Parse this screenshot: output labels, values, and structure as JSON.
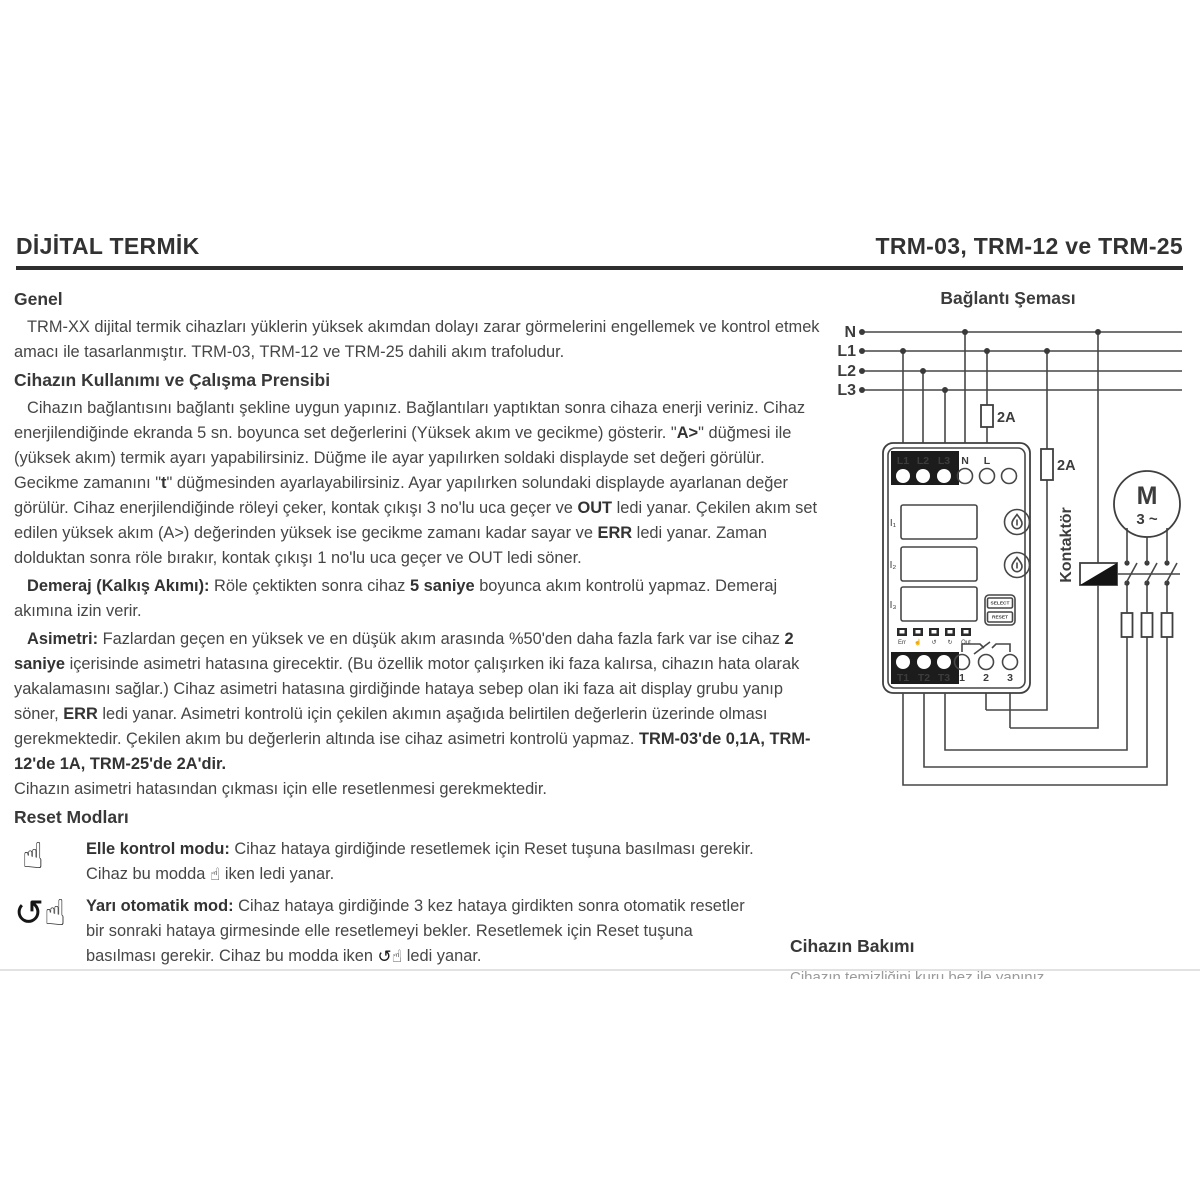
{
  "page": {
    "header": {
      "title_left": "DİJİTAL TERMİK",
      "title_right": "TRM-03, TRM-12 ve TRM-25"
    },
    "icons": {
      "manual_reset": "☝",
      "semi_auto_reset": "↺☝"
    },
    "sections": {
      "genel_heading": "Genel",
      "genel_paragraph": [
        {
          "t": "TRM-XX dijital termik cihazları yüklerin yüksek akımdan dolayı zarar görmelerini engellemek ve kontrol etmek amacı ile tasarlanmıştır. TRM-03, TRM-12 ve TRM-25 dahili akım trafoludur.",
          "b": false
        }
      ],
      "usage_heading": "Cihazın Kullanımı ve Çalışma Prensibi",
      "usage_paragraph": [
        {
          "t": "Cihazın bağlantısını bağlantı şekline uygun yapınız. Bağlantıları yaptıktan sonra cihaza enerji veriniz. Cihaz enerjilendiğinde ekranda 5 sn. boyunca set değerlerini (Yüksek akım ve gecikme) gösterir. \"",
          "b": false
        },
        {
          "t": "A>",
          "b": true
        },
        {
          "t": "\" düğmesi ile (yüksek akım) termik ayarı yapabilirsiniz. Düğme ile ayar yapılırken soldaki displayde set değeri görülür. Gecikme zamanını \"",
          "b": false
        },
        {
          "t": "t",
          "b": true
        },
        {
          "t": "\" düğmesinden ayarlayabilirsiniz. Ayar yapılırken solundaki displayde ayarlanan değer görülür. Cihaz enerjilendiğinde röleyi çeker, kontak çıkışı 3 no'lu uca geçer ve ",
          "b": false
        },
        {
          "t": "OUT",
          "b": true
        },
        {
          "t": " ledi yanar. Çekilen akım set edilen yüksek akım (A>) değerinden yüksek ise gecikme zamanı kadar sayar ve ",
          "b": false
        },
        {
          "t": "ERR",
          "b": true
        },
        {
          "t": " ledi yanar. Zaman dolduktan sonra röle bırakır, kontak çıkışı 1 no'lu uca geçer ve OUT ledi söner.",
          "b": false
        }
      ],
      "demeraj_paragraph": [
        {
          "t": "Demeraj (Kalkış Akımı):",
          "b": true
        },
        {
          "t": " Röle çektikten sonra cihaz ",
          "b": false
        },
        {
          "t": "5 saniye",
          "b": true
        },
        {
          "t": " boyunca akım kontrolü yapmaz. Demeraj akımına izin verir.",
          "b": false
        }
      ],
      "asimetri_paragraph": [
        {
          "t": "Asimetri:",
          "b": true
        },
        {
          "t": " Fazlardan geçen en yüksek ve en düşük akım arasında %50'den daha fazla fark var ise cihaz ",
          "b": false
        },
        {
          "t": "2 saniye",
          "b": true
        },
        {
          "t": " içerisinde asimetri hatasına girecektir. (Bu özellik motor çalışırken iki faza kalırsa, cihazın hata olarak yakalamasını sağlar.) Cihaz asimetri hatasına girdiğinde hataya sebep olan iki faza ait display grubu yanıp söner, ",
          "b": false
        },
        {
          "t": "ERR",
          "b": true
        },
        {
          "t": " ledi yanar. Asimetri kontrolü için çekilen akımın aşağıda belirtilen değerlerin üzerinde olması gerekmektedir. Çekilen akım bu değerlerin altında ise cihaz asimetri kontrolü yapmaz. ",
          "b": false
        },
        {
          "t": "TRM-03'de 0,1A, TRM-12'de 1A, TRM-25'de 2A'dir.",
          "b": true
        }
      ],
      "asimetri_line2": [
        {
          "t": "Cihazın asimetri hatasından çıkması için elle resetlenmesi gerekmektedir.",
          "b": false
        }
      ],
      "reset_heading": "Reset Modları",
      "reset_modes": [
        {
          "icon": "manual_reset",
          "segments": [
            {
              "t": "Elle kontrol modu:",
              "b": true
            },
            {
              "t": " Cihaz hataya girdiğinde resetlemek için Reset tuşuna basılması gerekir. Cihaz bu modda ",
              "b": false
            },
            {
              "icon": "manual_reset"
            },
            {
              "t": " iken ledi yanar.",
              "b": false
            }
          ]
        },
        {
          "icon": "semi_auto_reset",
          "segments": [
            {
              "t": "Yarı otomatik mod:",
              "b": true
            },
            {
              "t": " Cihaz hataya girdiğinde 3 kez hataya girdikten sonra otomatik resetler bir sonraki hataya girmesinde elle resetlemeyi bekler. Resetlemek için Reset tuşuna basılması gerekir. Cihaz bu modda iken ",
              "b": false
            },
            {
              "icon": "semi_auto_reset"
            },
            {
              "t": " ledi yanar.",
              "b": false
            }
          ]
        }
      ],
      "maintenance_heading": "Cihazın Bakımı",
      "maintenance_clipped_line": "Cihazın temizliğini kuru bez ile yapınız."
    },
    "diagram": {
      "title": "Bağlantı Şeması",
      "bus_labels": [
        "N",
        "L1",
        "L2",
        "L3"
      ],
      "fuse1_label": "2A",
      "fuse2_label": "2A",
      "contactor_label": "Kontaktör",
      "motor_label": "M",
      "motor_sub": "3 ~",
      "device": {
        "top_terminals_dark": [
          "L1",
          "L2",
          "L3"
        ],
        "top_terminals_light": [
          "N",
          "L"
        ],
        "displays": [
          "I₁",
          "I₂",
          "I₃"
        ],
        "select_button": "SELECT",
        "reset_button": "RESET",
        "led_labels": [
          "Err",
          "☝",
          "↺",
          "↻",
          "Out"
        ],
        "bottom_terminals_dark": [
          "T1",
          "T2",
          "T3"
        ],
        "bottom_terminals_light": [
          "1",
          "2",
          "3"
        ]
      }
    }
  }
}
